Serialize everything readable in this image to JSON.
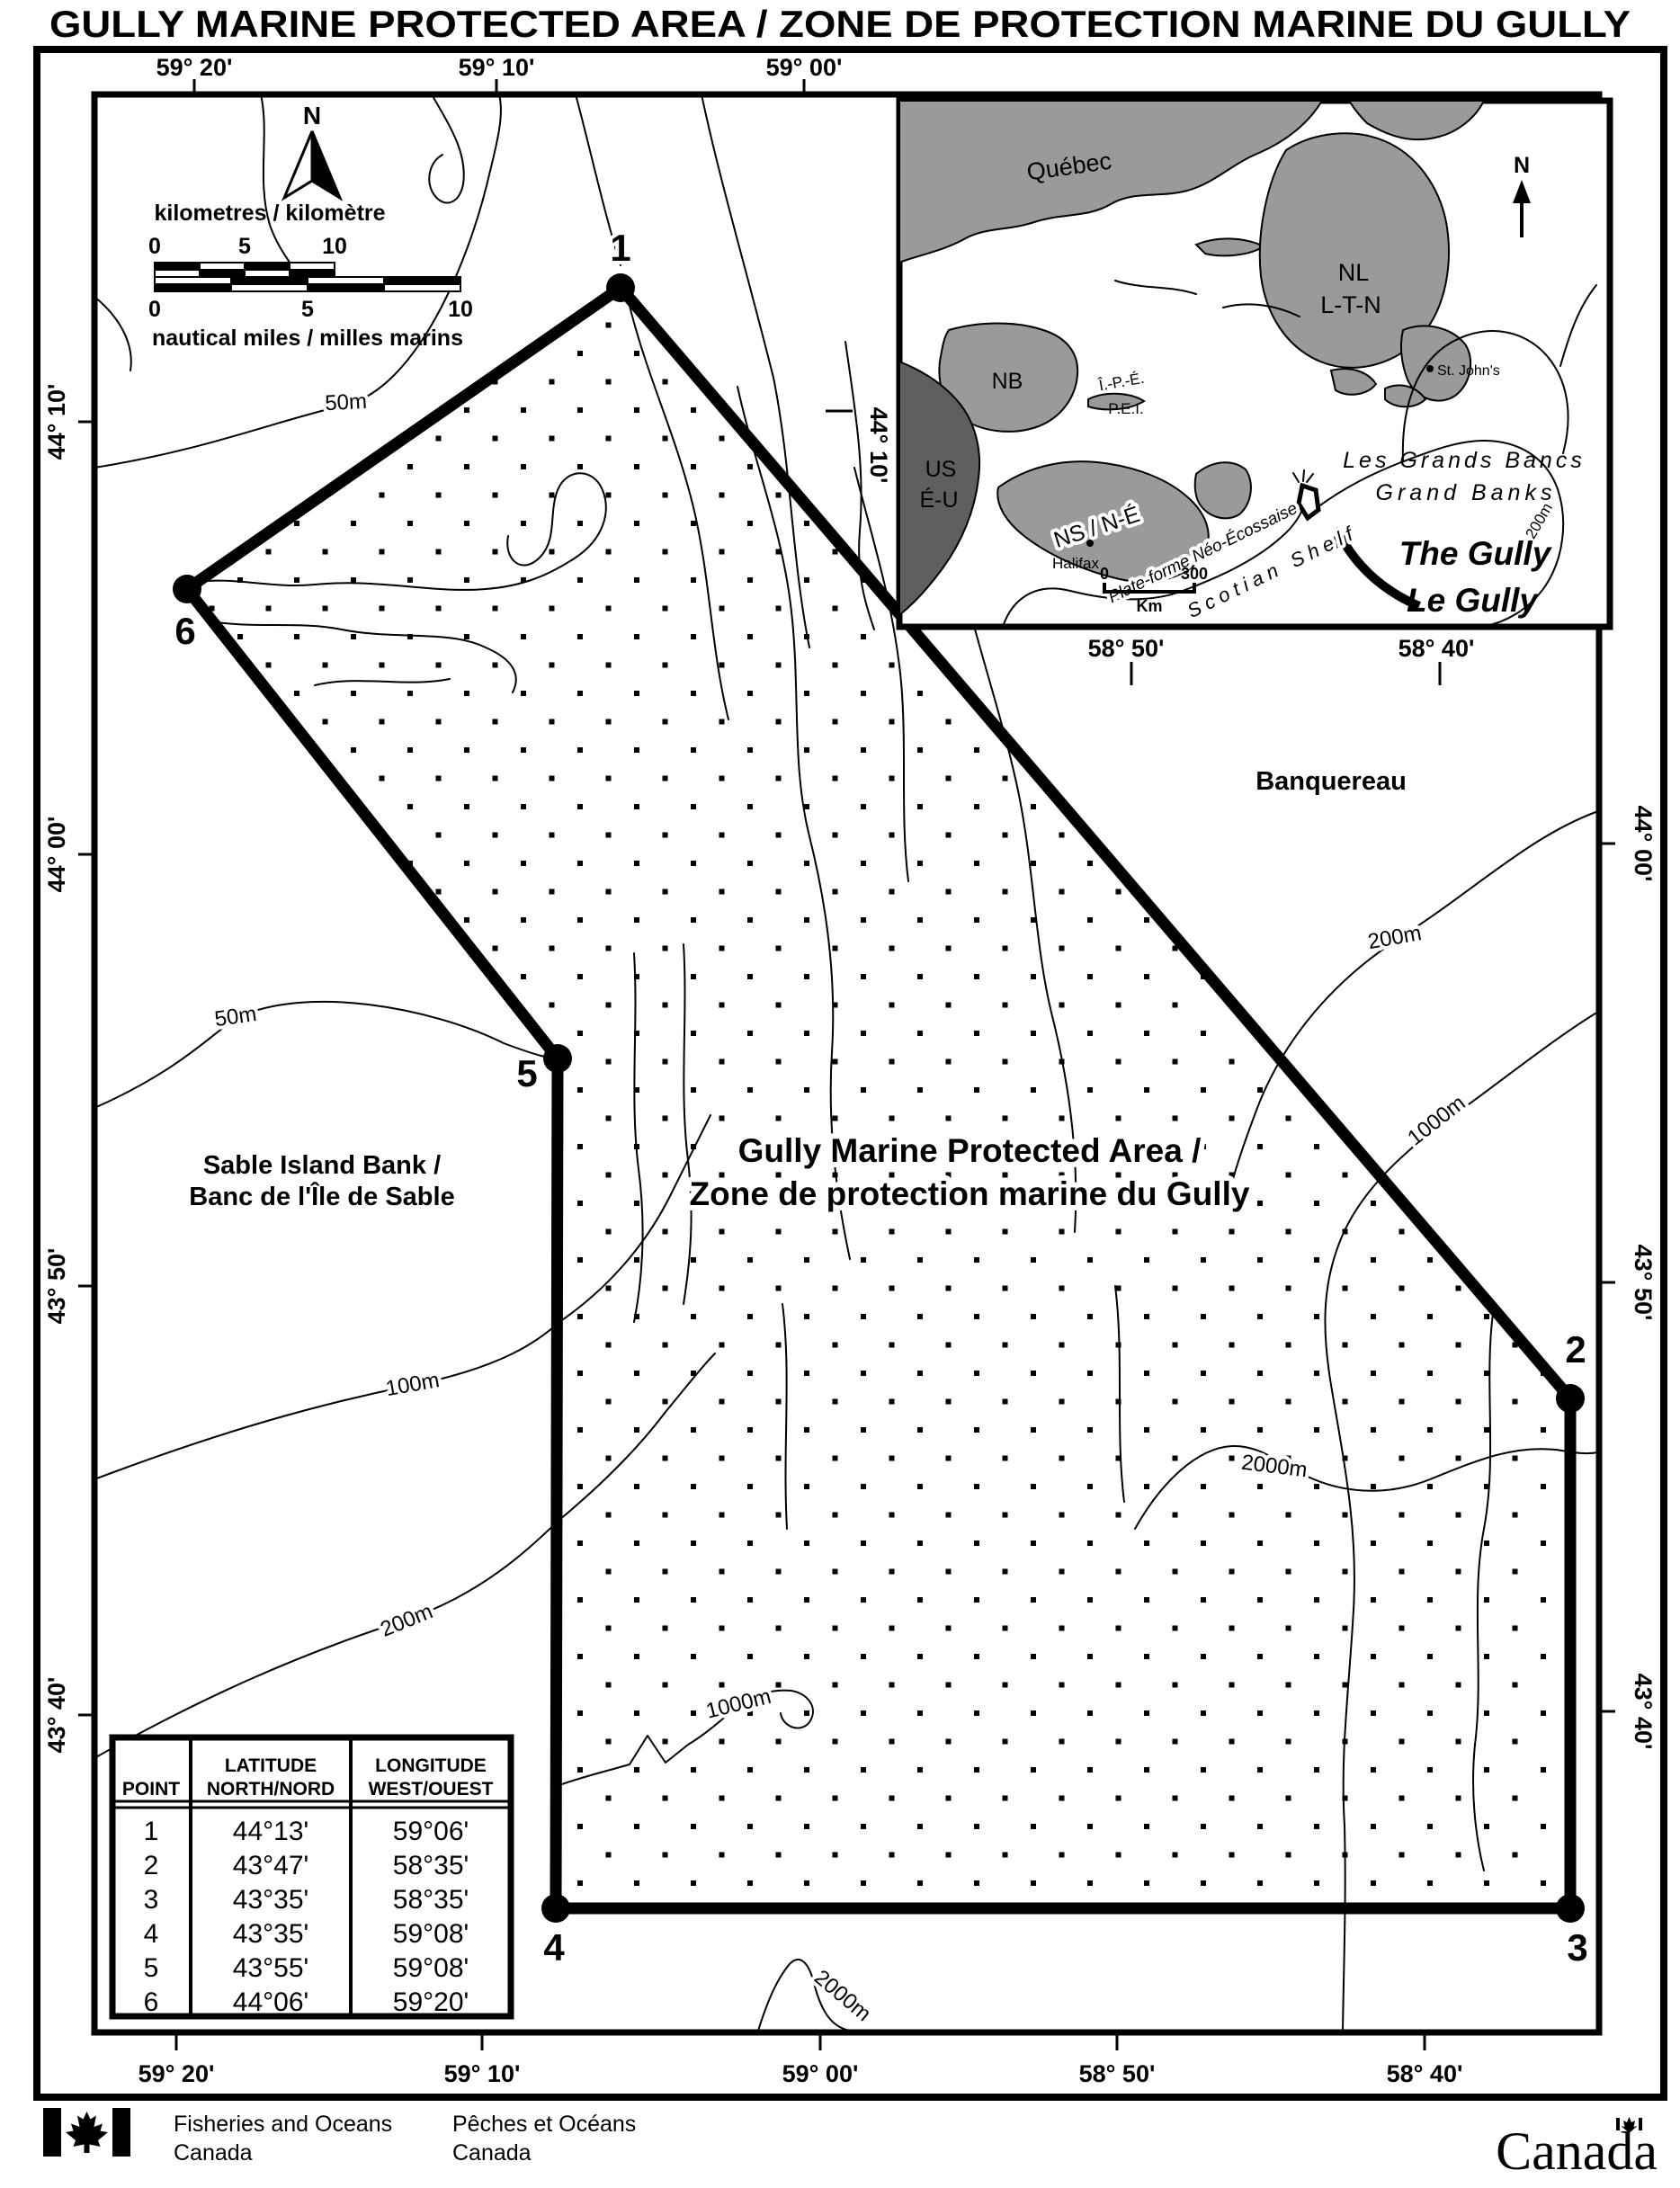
{
  "title": "GULLY MARINE PROTECTED AREA / ZONE DE PROTECTION MARINE DU GULLY",
  "axes": {
    "top": [
      "59° 20'",
      "59° 10'",
      "59° 00'"
    ],
    "top_displaced": [
      "58° 50'",
      "58° 40'"
    ],
    "bottom": [
      "59° 20'",
      "59° 10'",
      "59° 00'",
      "58° 50'",
      "58° 40'"
    ],
    "left": [
      "44° 10'",
      "44° 00'",
      "43° 50'",
      "43° 40'"
    ],
    "right": [
      "44° 00'",
      "43° 50'",
      "43° 40'"
    ],
    "right_displaced": "44° 10'"
  },
  "north_arrow": {
    "label": "N"
  },
  "scalebar": {
    "km_title": "kilometres / kilomètre",
    "nm_title": "nautical miles / milles marins",
    "ticks": [
      "0",
      "5",
      "10"
    ]
  },
  "map_labels": {
    "mpa_line1": "Gully Marine Protected Area /",
    "mpa_line2": "Zone de protection marine du Gully",
    "banquereau": "Banquereau",
    "sable_line1": "Sable Island Bank /",
    "sable_line2": "Banc de l'Île de Sable"
  },
  "contour_labels": {
    "c50_top": "50m",
    "c50_mid": "50m",
    "c100": "100m",
    "c200_left": "200m",
    "c200_right": "200m",
    "c1000_right": "1000m",
    "c2000_mid": "2000m",
    "c1000_inner": "1000m",
    "c2000_bottom": "2000m"
  },
  "boundary_points": {
    "p1": "1",
    "p2": "2",
    "p3": "3",
    "p4": "4",
    "p5": "5",
    "p6": "6"
  },
  "inset": {
    "north_label": "N",
    "labels": {
      "quebec": "Québec",
      "nb": "NB",
      "pei_fr": "Î.-P.-É.",
      "pei_en": "P.E.I.",
      "us_en": "US",
      "us_fr": "É-U",
      "ns": "NS / N-É",
      "halifax": "Halifax",
      "nl": "NL",
      "nl_fr": "L-T-N",
      "st_johns": "St. John's",
      "grand_banks_fr": "Les Grands Bancs",
      "grand_banks_en": "Grand Banks",
      "shelf_fr": "Plate-forme Néo-Écossaise",
      "shelf_en": "Scotian Shelf",
      "gully_en": "The Gully",
      "gully_fr": "Le Gully",
      "c200": "200m"
    },
    "scale": {
      "zero": "0",
      "max": "300",
      "unit": "Km"
    }
  },
  "table": {
    "headers": {
      "point": "POINT",
      "lat_line1": "LATITUDE",
      "lat_line2": "NORTH/NORD",
      "lon_line1": "LONGITUDE",
      "lon_line2": "WEST/OUEST"
    },
    "rows": [
      {
        "point": "1",
        "lat": "44°13'",
        "lon": "59°06'"
      },
      {
        "point": "2",
        "lat": "43°47'",
        "lon": "58°35'"
      },
      {
        "point": "3",
        "lat": "43°35'",
        "lon": "58°35'"
      },
      {
        "point": "4",
        "lat": "43°35'",
        "lon": "59°08'"
      },
      {
        "point": "5",
        "lat": "43°55'",
        "lon": "59°08'"
      },
      {
        "point": "6",
        "lat": "44°06'",
        "lon": "59°20'"
      }
    ]
  },
  "footer": {
    "dept_en_line1": "Fisheries and Oceans",
    "dept_en_line2": "Canada",
    "dept_fr_line1": "Pêches et Océans",
    "dept_fr_line2": "Canada",
    "wordmark": "Canada"
  },
  "colors": {
    "land_gray": "#9a9a9a",
    "us_gray": "#5f5f5f",
    "ink": "#000000",
    "paper": "#ffffff"
  }
}
